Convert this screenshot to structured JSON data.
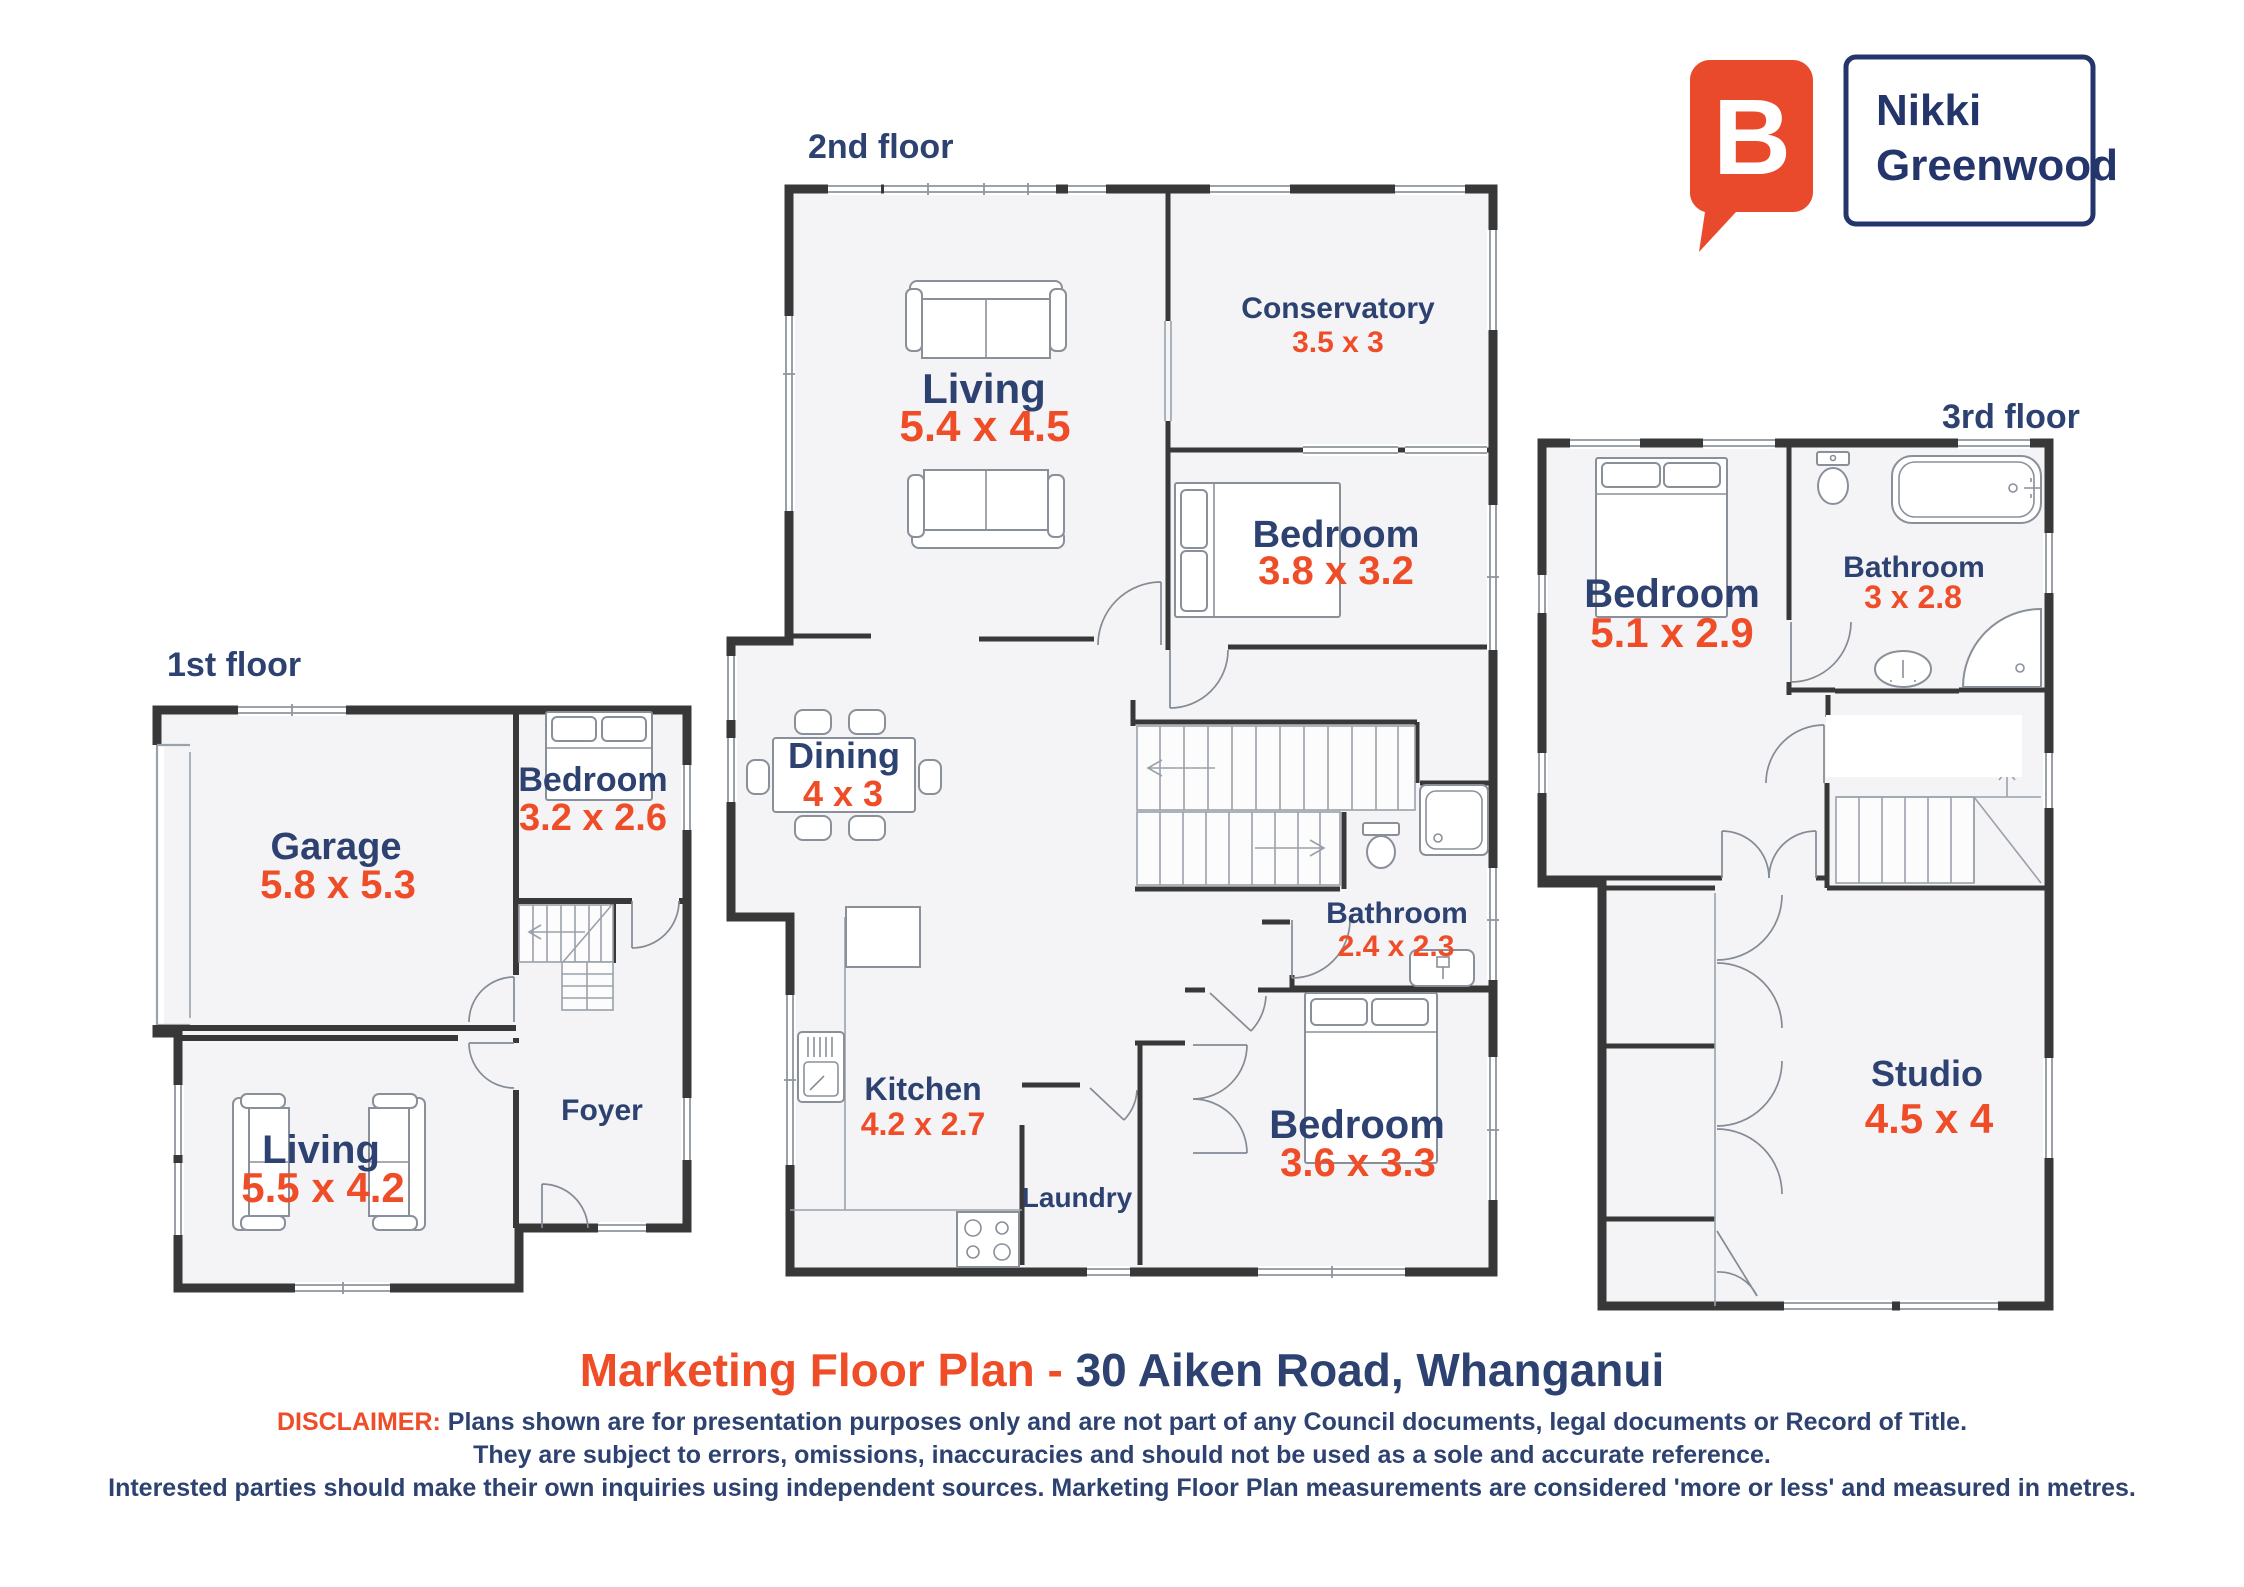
{
  "colors": {
    "navy": "#2D4270",
    "orange": "#EF4C28",
    "wall": "#383838",
    "floor_fill": "#F4F4F6",
    "logo_orange": "#E94A2B",
    "logo_navy": "#24356B"
  },
  "brand": {
    "logo_letter": "B",
    "name_line1": "Nikki",
    "name_line2": "Greenwood"
  },
  "title": {
    "marketing": "Marketing Floor Plan - ",
    "address": "30 Aiken Road, Whanganui"
  },
  "disclaimer": {
    "label": "DISCLAIMER:",
    "line1": "Plans shown are for presentation purposes only and are not part of any Council documents, legal documents or Record of Title.",
    "line2": "They are subject to errors, omissions, inaccuracies and should not be used as a sole and accurate reference.",
    "line3": "Interested parties should make their own inquiries using independent sources. Marketing Floor Plan measurements are considered 'more or less' and measured in metres."
  },
  "floors": [
    {
      "label": "1st floor",
      "rooms": [
        {
          "name": "Garage",
          "dims": "5.8 x 5.3"
        },
        {
          "name": "Bedroom",
          "dims": "3.2 x 2.6"
        },
        {
          "name": "Living",
          "dims": "5.5 x 4.2"
        },
        {
          "name": "Foyer",
          "dims": ""
        }
      ]
    },
    {
      "label": "2nd floor",
      "rooms": [
        {
          "name": "Living",
          "dims": "5.4 x 4.5"
        },
        {
          "name": "Conservatory",
          "dims": "3.5 x 3"
        },
        {
          "name": "Bedroom",
          "dims": "3.8 x 3.2"
        },
        {
          "name": "Dining",
          "dims": "4 x 3"
        },
        {
          "name": "Kitchen",
          "dims": "4.2 x 2.7"
        },
        {
          "name": "Bathroom",
          "dims": "2.4 x 2.3"
        },
        {
          "name": "Bedroom",
          "dims": "3.6 x 3.3"
        },
        {
          "name": "Laundry",
          "dims": ""
        }
      ]
    },
    {
      "label": "3rd floor",
      "rooms": [
        {
          "name": "Bedroom",
          "dims": "5.1 x 2.9"
        },
        {
          "name": "Bathroom",
          "dims": "3 x 2.8"
        },
        {
          "name": "Studio",
          "dims": "4.5 x 4"
        }
      ]
    }
  ]
}
